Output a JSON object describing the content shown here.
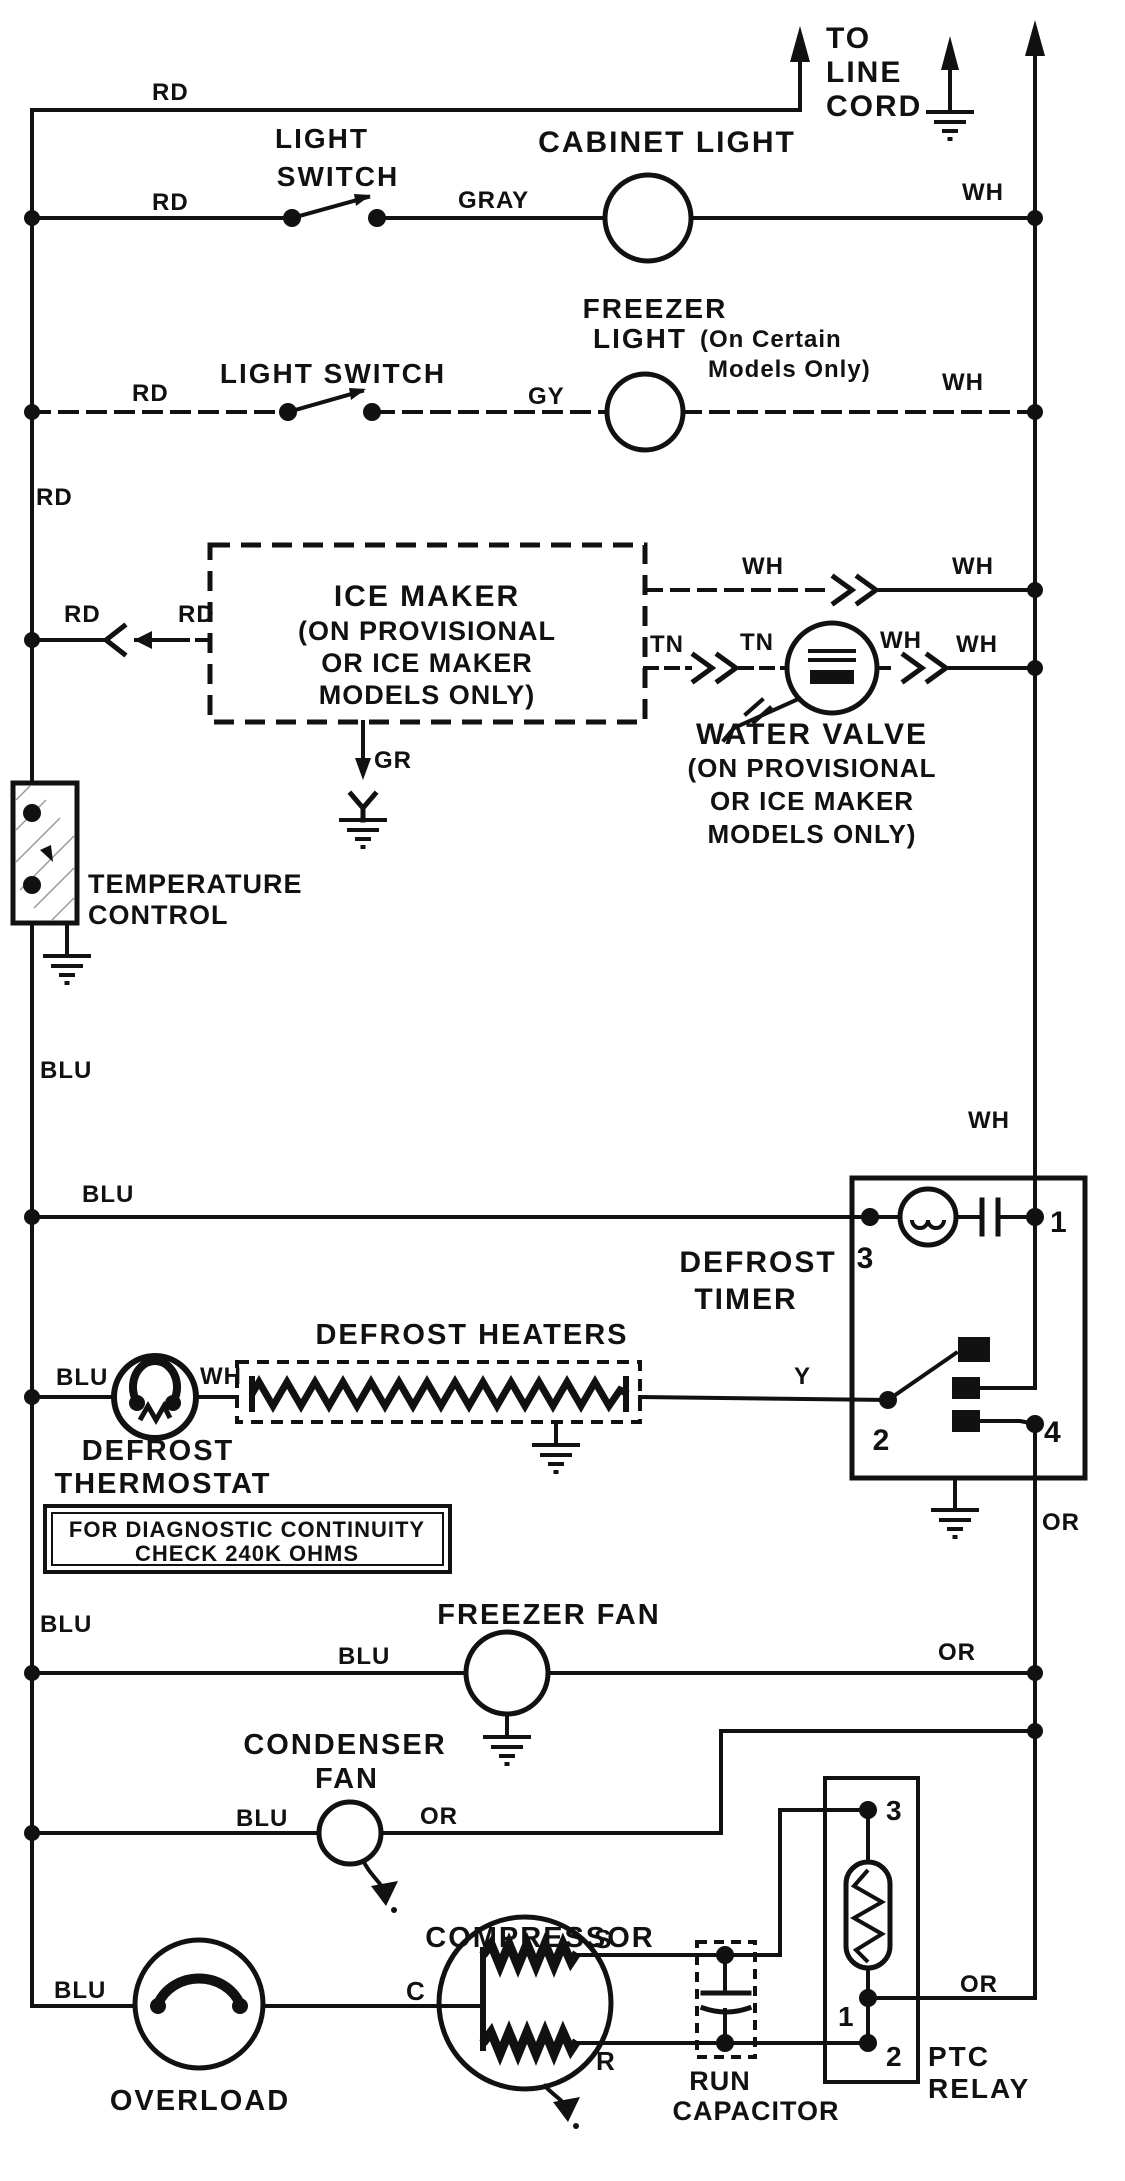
{
  "colors": {
    "ink": "#111111",
    "paper": "#ffffff"
  },
  "power": {
    "rd_top": "RD",
    "to": "TO",
    "line": "LINE",
    "cord": "CORD"
  },
  "cabinet_light_circuit": {
    "switch_label_1": "LIGHT",
    "switch_label_2": "SWITCH",
    "light_label": "CABINET LIGHT",
    "wire_rd": "RD",
    "wire_gray": "GRAY",
    "wire_wh": "WH"
  },
  "freezer_light_circuit": {
    "switch_label": "LIGHT SWITCH",
    "light_label_1": "FREEZER",
    "light_label_2": "LIGHT",
    "note_1": "(On Certain",
    "note_2": "Models Only)",
    "wire_rd": "RD",
    "wire_gy": "GY",
    "wire_wh": "WH"
  },
  "left_rail": {
    "rd": "RD",
    "blu": "BLU"
  },
  "ice_maker": {
    "name_1": "ICE MAKER",
    "name_2": "(ON PROVISIONAL",
    "name_3": "OR ICE MAKER",
    "name_4": "MODELS ONLY)",
    "wire_rd_a": "RD",
    "wire_rd_b": "RD",
    "wire_gr": "GR",
    "wh_a": "WH",
    "wh_b": "WH",
    "tn_a": "TN",
    "tn_b": "TN"
  },
  "water_valve": {
    "name_1": "WATER VALVE",
    "name_2": "(ON PROVISIONAL",
    "name_3": "OR ICE MAKER",
    "name_4": "MODELS ONLY)",
    "wire_wh_a": "WH",
    "wire_wh_b": "WH"
  },
  "temperature_control": {
    "name_1": "TEMPERATURE",
    "name_2": "CONTROL"
  },
  "defrost_timer": {
    "name_1": "DEFROST",
    "name_2": "TIMER",
    "terminal_1": "1",
    "terminal_2": "2",
    "terminal_3": "3",
    "terminal_4": "4",
    "wire_wh": "WH",
    "wire_or": "OR",
    "wire_y": "Y",
    "wire_blu": "BLU"
  },
  "defrost_thermostat": {
    "name_1": "DEFROST",
    "name_2": "THERMOSTAT",
    "wire_blu": "BLU",
    "wire_wh": "WH"
  },
  "defrost_heaters": {
    "name": "DEFROST HEATERS"
  },
  "diagnostic_note": {
    "line_1": "FOR DIAGNOSTIC CONTINUITY",
    "line_2": "CHECK 240K OHMS"
  },
  "freezer_fan": {
    "name": "FREEZER FAN",
    "wire_blu_a": "BLU",
    "wire_blu_b": "BLU",
    "wire_or": "OR"
  },
  "condenser_fan": {
    "name_1": "CONDENSER",
    "name_2": "FAN",
    "wire_blu": "BLU",
    "wire_or": "OR"
  },
  "overload": {
    "name": "OVERLOAD",
    "wire_blu": "BLU"
  },
  "compressor": {
    "name": "COMPRESSOR",
    "terminal_c": "C",
    "terminal_s": "S",
    "terminal_r": "R"
  },
  "run_capacitor": {
    "name_1": "RUN",
    "name_2": "CAPACITOR"
  },
  "ptc_relay": {
    "name_1": "PTC",
    "name_2": "RELAY",
    "terminal_1": "1",
    "terminal_2": "2",
    "terminal_3": "3",
    "wire_or": "OR"
  }
}
